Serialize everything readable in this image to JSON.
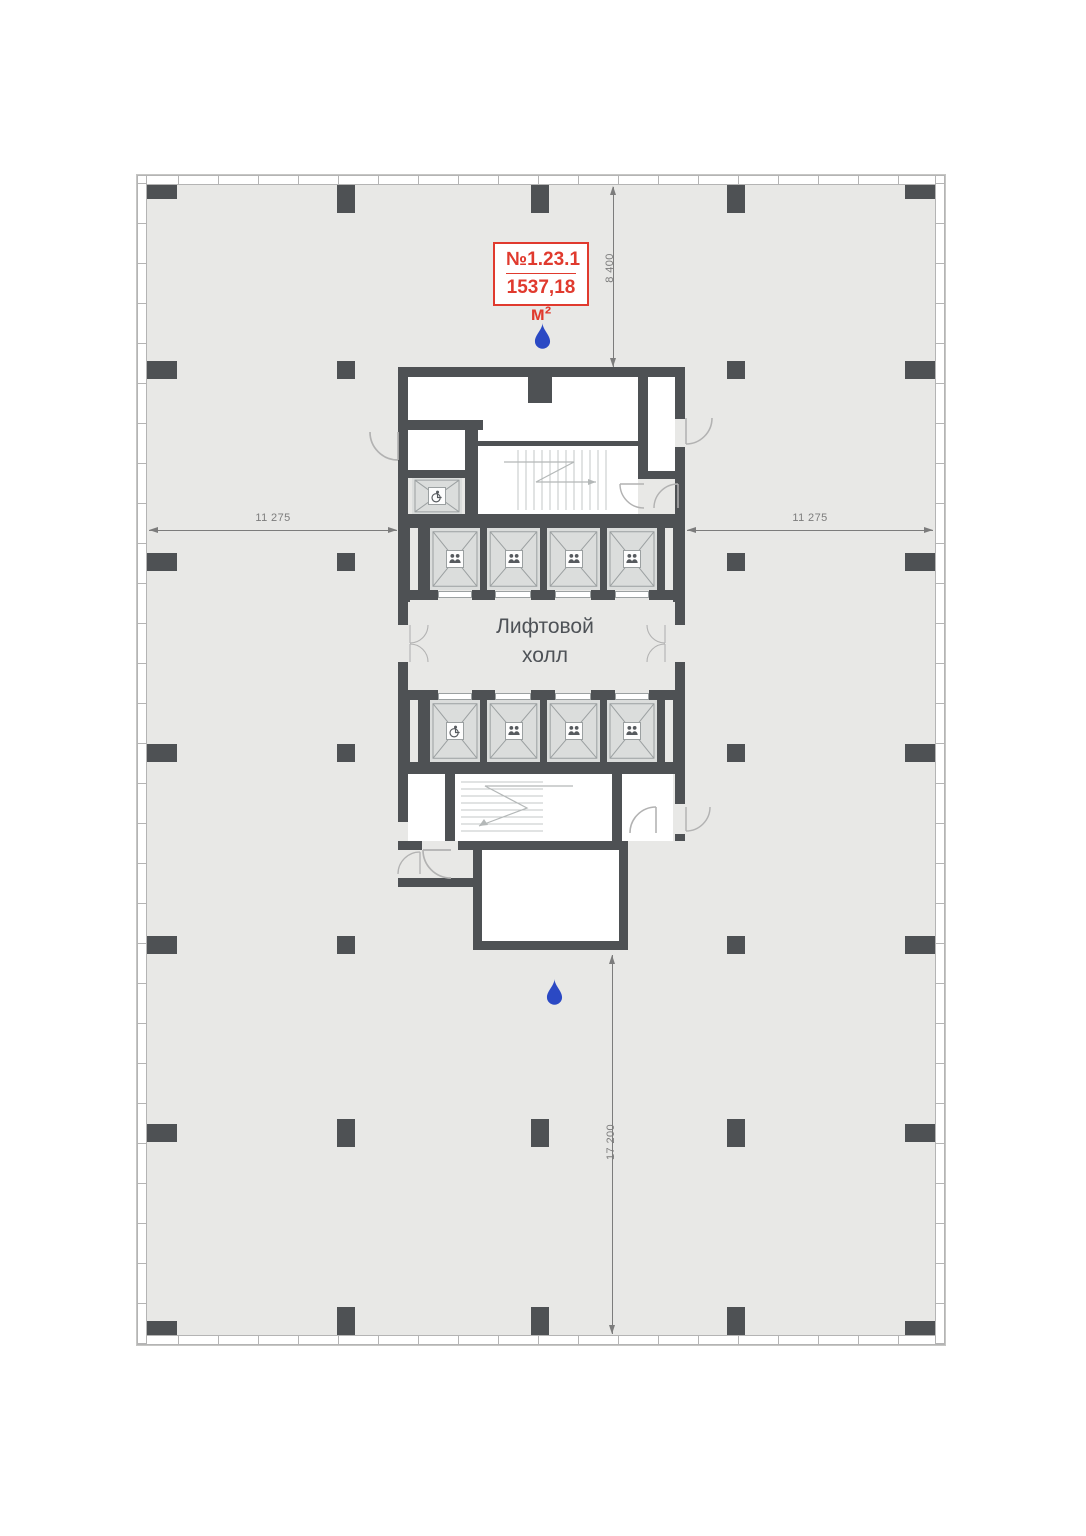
{
  "unit": {
    "number": "№1.23.1",
    "area": "1537,18 м²"
  },
  "labels": {
    "elevator_hall_line1": "Лифтовой",
    "elevator_hall_line2": "холл"
  },
  "dimensions": {
    "top_vertical": "8 400",
    "left_horizontal": "11 275",
    "right_horizontal": "11 275",
    "bottom_vertical": "17 200"
  },
  "colors": {
    "floor": "#e8e8e6",
    "wall": "#4e5154",
    "room": "#ffffff",
    "shaft_fill": "#dbdddc",
    "shaft_line": "#9ba0a1",
    "unit_accent": "#e03a2e",
    "marker_blue": "#2b49c4",
    "dim": "#7c7c7c",
    "mullion": "#b4b4b4",
    "hall_text": "#4e5257"
  },
  "icons": {
    "entrance_marker": "water-drop",
    "passenger_elevator": "two-people",
    "accessible_elevator": "wheelchair"
  }
}
